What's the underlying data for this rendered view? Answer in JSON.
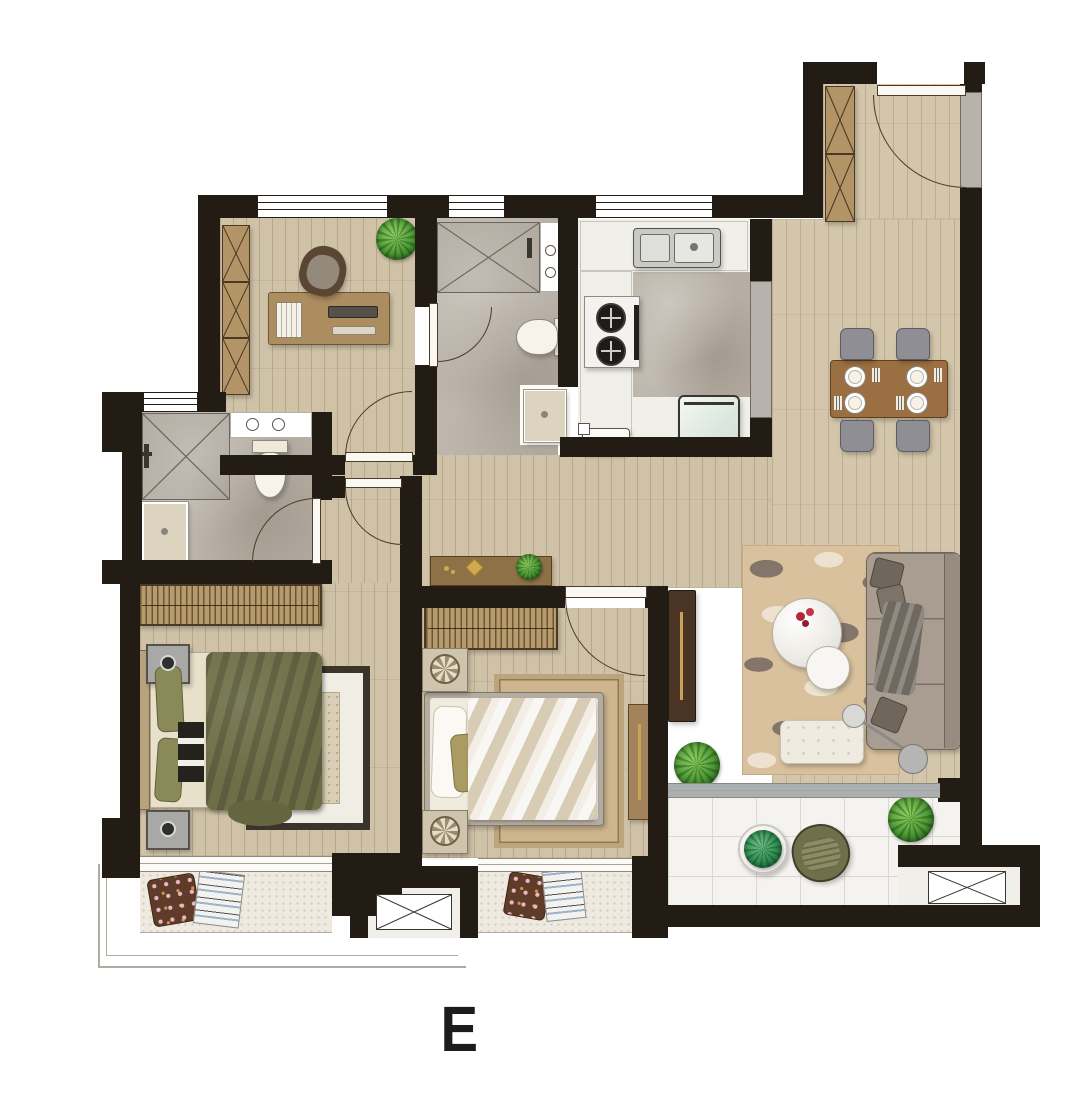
{
  "page": {
    "background": "#ffffff",
    "unit_label": "E"
  },
  "colors": {
    "wall": "#231c15",
    "wood_floor": "#cfc2a7",
    "marble_floor": "#b6aea3",
    "white_floor": "#f1efe9",
    "balcony_tile": "#f4f3ef",
    "speckle_floor": "#efeadf",
    "wardrobe_wood": "#b79b6d",
    "cabinet_wood": "#b39466",
    "table_wood": "#9c6f42",
    "dark_wood": "#4a3423",
    "gold_accent": "#c9a457",
    "sofa_gray": "#a89d90",
    "chair_gray": "#8e8e94",
    "rug_tan": "#d8c19c",
    "rug_pattern": "#84756a",
    "duvet_olive": "#6e6f47",
    "bed_cream": "#e8e0ca",
    "plant_green": "#4f9b36",
    "door_arc": "#4e3b28",
    "appliance_steel": "#c9c9c6",
    "railing": "#b0aba1"
  },
  "icons": {
    "ac-outdoor-unit-icon": "rectangle-with-x",
    "shower-area-icon": "tile-square-with-x",
    "door-swing-icon": "quarter-circle-arc",
    "window-icon": "bar-with-parallel-lines",
    "wardrobe-icon": "strip-of-hangers",
    "stove-icon": "two-burner-circles",
    "kitchen-sink-icon": "double-basin",
    "dining-set-icon": "table-with-4-chairs-and-plates",
    "toilet-icon": "tank-and-bowl",
    "plant-icon": "green-radial-bush"
  }
}
